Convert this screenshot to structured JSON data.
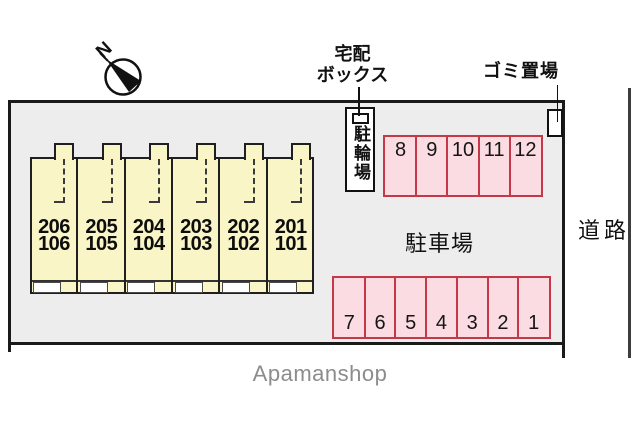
{
  "compass": {
    "north_label": "N"
  },
  "labels": {
    "delivery_box_line1": "宅配",
    "delivery_box_line2": "ボックス",
    "garbage": "ゴミ置場",
    "bicycle_parking": "駐輪場",
    "parking_lot": "駐車場",
    "road": "道路"
  },
  "building": {
    "units": [
      {
        "upper": "206",
        "lower": "106"
      },
      {
        "upper": "205",
        "lower": "105"
      },
      {
        "upper": "204",
        "lower": "104"
      },
      {
        "upper": "203",
        "lower": "103"
      },
      {
        "upper": "202",
        "lower": "102"
      },
      {
        "upper": "201",
        "lower": "101"
      }
    ]
  },
  "parking": {
    "top_row": [
      "8",
      "9",
      "10",
      "11",
      "12"
    ],
    "bottom_row": [
      "7",
      "6",
      "5",
      "4",
      "3",
      "2",
      "1"
    ]
  },
  "footer": {
    "brand": "Apamanshop"
  },
  "colors": {
    "site_fill": "#ededed",
    "building_fill": "#faf5c6",
    "parking_fill": "#fbdce2",
    "parking_border": "#c43848",
    "line": "#1a1a1a",
    "brand_text": "#8c8c8c"
  }
}
